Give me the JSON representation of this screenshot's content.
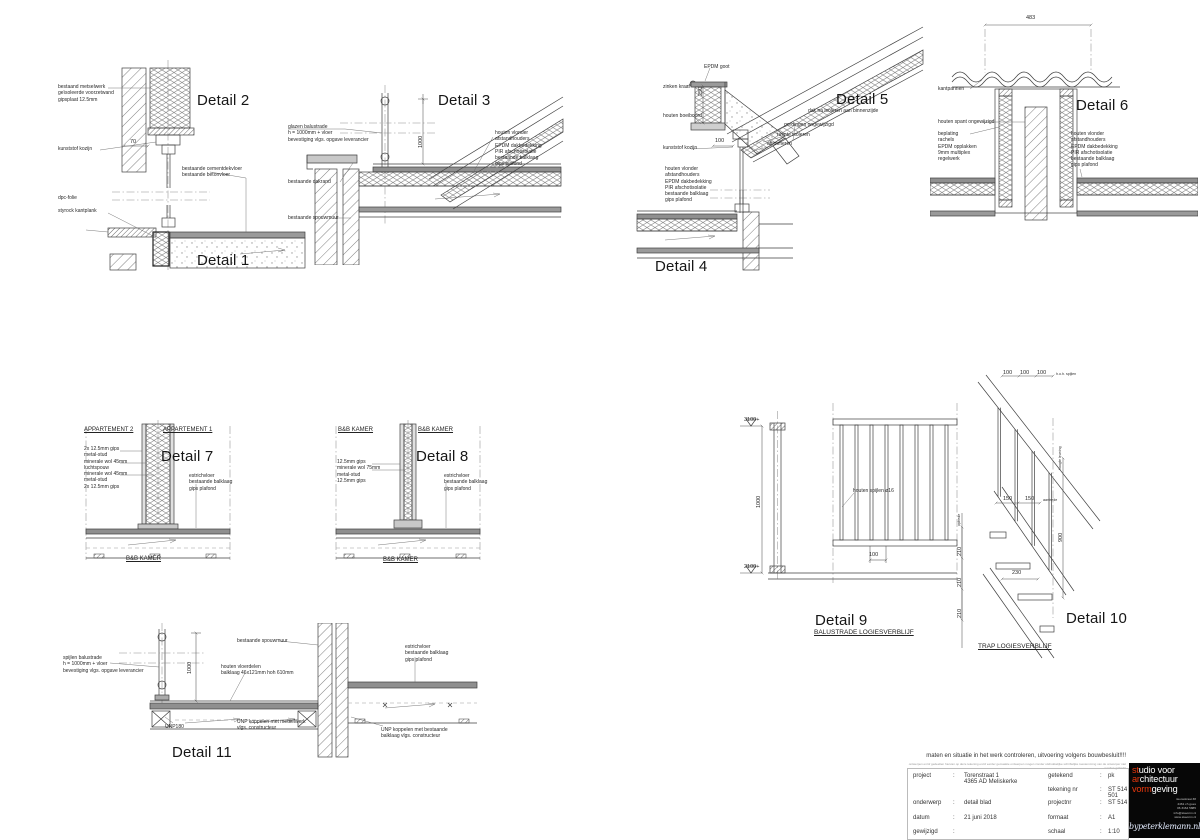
{
  "colors": {
    "background": "#ffffff",
    "line": "#3f3f3f",
    "accent_red": "#e8380d"
  },
  "details": {
    "d12": {
      "title_top": "Detail 2",
      "title_bottom": "Detail 1",
      "labels": [
        "bestaand metselwerk\ngeïsoleerde voorzetwand\ngipsplaat 12.5mm",
        "kunststof kozijn",
        "bestaande cementdekvloer\nbestaande betonvloer",
        "dpc-folie",
        "styrock kantplank"
      ],
      "dims": [
        "70"
      ]
    },
    "d3": {
      "title": "Detail 3",
      "labels": [
        "glazen balustrade\nh = 1000mm + vloer\nbevestiging vlgs. opgave leverancier",
        "bestaande dakrand",
        "bestaande spouwmuur",
        "houten vlonder\nafstandhouders\nEPDM dakbedekking\nPIR afschotisolatie\nbestaande balklaag\ngips plafond"
      ],
      "dims": [
        "1000"
      ]
    },
    "d5": {
      "title": "Detail 5",
      "labels": [
        "EPDM goot",
        "zinken kraal",
        "houten boeiboord",
        "kunststof kozijn",
        "dak na isoleren aan binnenzijde",
        "gordingen ongewijzigd",
        "ruimte isoleren",
        "aftimmeren"
      ],
      "dims": [
        "250",
        "100"
      ]
    },
    "d4": {
      "title": "Detail 4",
      "labels": [
        "houten vlonder\nafstandhouders\nEPDM dakbedekking\nPIR afschotisolatie\nbestaande balklaag\ngips plafond"
      ]
    },
    "d6": {
      "title": "Detail 6",
      "labels": [
        "kantpannen",
        "houten spant ongewijzigd",
        "beplating\nrachels\nEPDM opplakken\n9mm multiplex\nregelwerk",
        "houten vlonder\nafstandhouders\nEPDM dakbedekking\nPIR afschotisolatie\nbestaande balklaag\ngips plafond"
      ],
      "dims": [
        "483"
      ]
    },
    "d7": {
      "title": "Detail 7",
      "headers": [
        "APPARTEMENT 2",
        "APPARTEMENT 1"
      ],
      "labels": [
        "2x 12.5mm gips\nmetal-stud\nminerale wol 45mm\nluchtspouw\nminerale wol 45mm\nmetal-stud\n2x 12.5mm gips",
        "estrichvloer\nbestaande balklaag\ngips plafond"
      ],
      "footer": "B&B KAMER"
    },
    "d8": {
      "title": "Detail 8",
      "headers": [
        "B&B KAMER",
        "B&B KAMER"
      ],
      "labels": [
        "12.5mm gips\nminerale wol 75mm\nmetal-stud\n12.5mm gips",
        "estrichvloer\nbestaande balklaag\ngips plafond"
      ],
      "footer": "B&B KAMER"
    },
    "d9": {
      "title": "Detail 9",
      "subtitle": "BALUSTRADE LOGIESVERBLIJF",
      "labels": [
        "houten spijlen ø16"
      ],
      "levels": [
        "3100+",
        "2100+"
      ],
      "dims": [
        "1000",
        "100"
      ]
    },
    "d10": {
      "title": "Detail 10",
      "subtitle": "TRAP LOGIESVERBLIJF",
      "dims_top": [
        "100",
        "100",
        "100"
      ],
      "dim_labels": [
        "h.o.h. spijlen",
        "hoogte leuning",
        "aantrede",
        "optrede"
      ],
      "dims": [
        "150",
        "150",
        "900",
        "230",
        "210",
        "210",
        "210"
      ]
    },
    "d11": {
      "title": "Detail 11",
      "labels": [
        "spijlen balustrade\nh = 1000mm + vloer\nbevestiging vlgs. opgave leverancier",
        "bestaande spouwmuur",
        "houten vloerdelen\nbalklaag 46x121mm hoh 610mm",
        "UNP180",
        "UNP koppelen met metselwerk\nvlgs. constructeur",
        "estrichvloer\nbestaande balklaag\ngips plafond",
        "UNP koppelen met bestaande\nbalklaag vlgs. constructeur"
      ],
      "dims": [
        "1000"
      ]
    }
  },
  "titleblock": {
    "warning": "maten en situatie in het werk controleren, uitvoering volgens bouwbesluit!!!!",
    "disclaimer": "ontwerpen en/of gedeelten hiervan op deze tekening en/of eerder gemaakte ontwerpen mogen zonder uitdrukkelijke schriftelijke toestemming van de ontwerper niet worden gebruikt",
    "sep": ":",
    "rows_left": [
      {
        "label": "project",
        "value": "Torenstraat 1\n4365 AD Meliskerke"
      },
      {
        "label": "onderwerp",
        "value": "detail blad"
      },
      {
        "label": "datum",
        "value": "21 juni 2018"
      },
      {
        "label": "gewijzigd",
        "value": ""
      }
    ],
    "rows_right": [
      {
        "label": "getekend",
        "value": "pk"
      },
      {
        "label": "tekening nr",
        "value": "ST 514 501"
      },
      {
        "label": "projectnr",
        "value": "ST 514"
      },
      {
        "label": "formaat",
        "value": "A1"
      },
      {
        "label": "schaal",
        "value": "1:10"
      }
    ],
    "logo": {
      "l1a": "st",
      "l1b": "udio voor",
      "l2a": "ar",
      "l2b": "chitectuur",
      "l3a": "vorm",
      "l3b": "geving",
      "address": [
        "nieuwstraat 38",
        "4461 ch goes",
        "06 3164 5885",
        "info@stavorm.nl",
        "www.stavorm.nl"
      ],
      "site": "bypeterklemann.nl"
    }
  }
}
